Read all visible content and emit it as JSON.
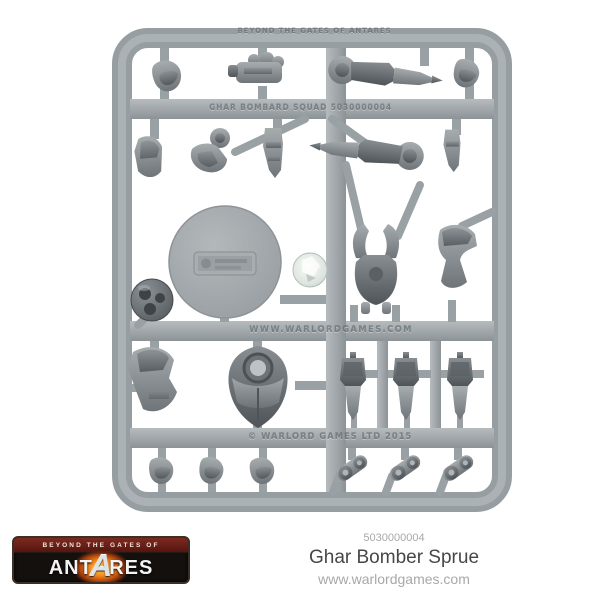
{
  "product": {
    "sku": "5030000004",
    "name": "Ghar Bomber Sprue",
    "website": "www.warlordgames.com"
  },
  "logo": {
    "tagline": "BEYOND THE GATES OF",
    "brand_left": "ANT",
    "brand_a": "A",
    "brand_right": "RES"
  },
  "sprue": {
    "embossed_top": "BEYOND THE GATES OF ANTARES",
    "embossed_upper": "GHAR BOMBARD SQUAD 5030000004",
    "embossed_middle": "WWW.WARLORDGAMES.COM",
    "embossed_bottom": "© WARLORD GAMES LTD 2015",
    "material_color": "#9ba1a5",
    "part_color": "#7e8488",
    "background_color": "#ffffff"
  }
}
